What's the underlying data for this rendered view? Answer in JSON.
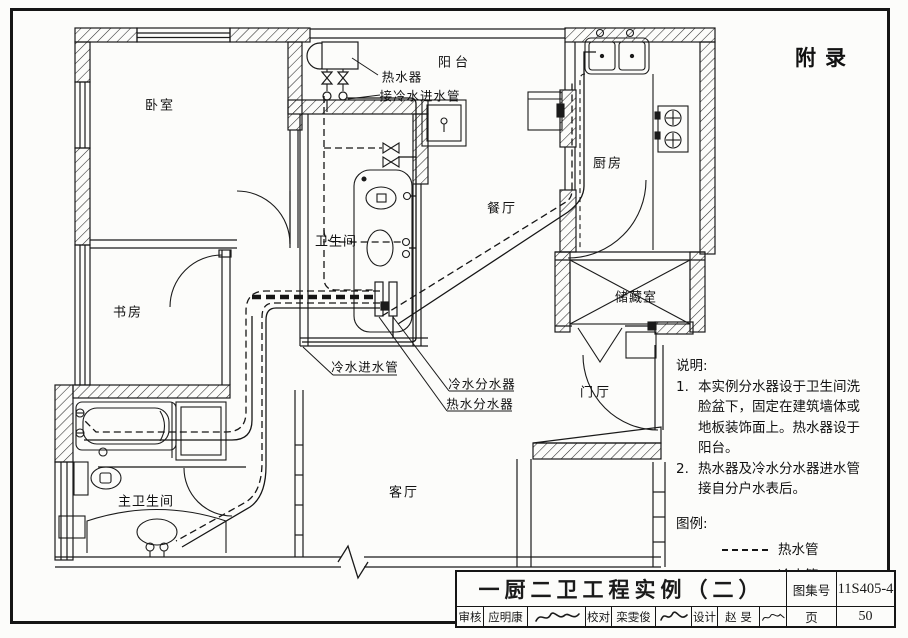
{
  "sheet": {
    "appendix": "附录"
  },
  "rooms": {
    "bedroom": "卧室",
    "study": "书房",
    "master_bathroom": "主卫生间",
    "bathroom": "卫生间",
    "balcony": "阳台",
    "dining_room": "餐厅",
    "kitchen": "厨房",
    "storage_room": "储藏室",
    "foyer": "门厅",
    "living_room": "客厅"
  },
  "annotations": {
    "water_heater": "热水器",
    "connect_cold_inlet": "接冷水进水管",
    "cold_water_inlet": "冷水进水管",
    "cold_water_manifold": "冷水分水器",
    "hot_water_manifold": "热水分水器"
  },
  "notes": {
    "heading": "说明:",
    "item1": {
      "number": "1.",
      "lines": [
        "本实例分水器设于卫生间洗",
        "脸盆下，固定在建筑墙体或",
        "地板装饰面上。热水器设于",
        "阳台。"
      ]
    },
    "item2": {
      "number": "2.",
      "lines": [
        "热水器及冷水分水器进水管",
        "接自分户水表后。"
      ]
    }
  },
  "legend": {
    "heading": "图例:",
    "hot_pipe": "热水管",
    "cold_pipe": "冷水管"
  },
  "title_block": {
    "title": "一厨二卫工程实例（二）",
    "atlas_label": "图集号",
    "atlas_number": "11S405-4",
    "page_label": "页",
    "page_number": "50",
    "reviewer_label": "审核",
    "reviewer_name": "应明康",
    "proofreader_label": "校对",
    "proofreader_name": "栾雯俊",
    "designer_label": "设计",
    "designer_name": "赵  旻"
  },
  "colors": {
    "ink": "#1a1a1a",
    "paper": "#ffffff"
  }
}
